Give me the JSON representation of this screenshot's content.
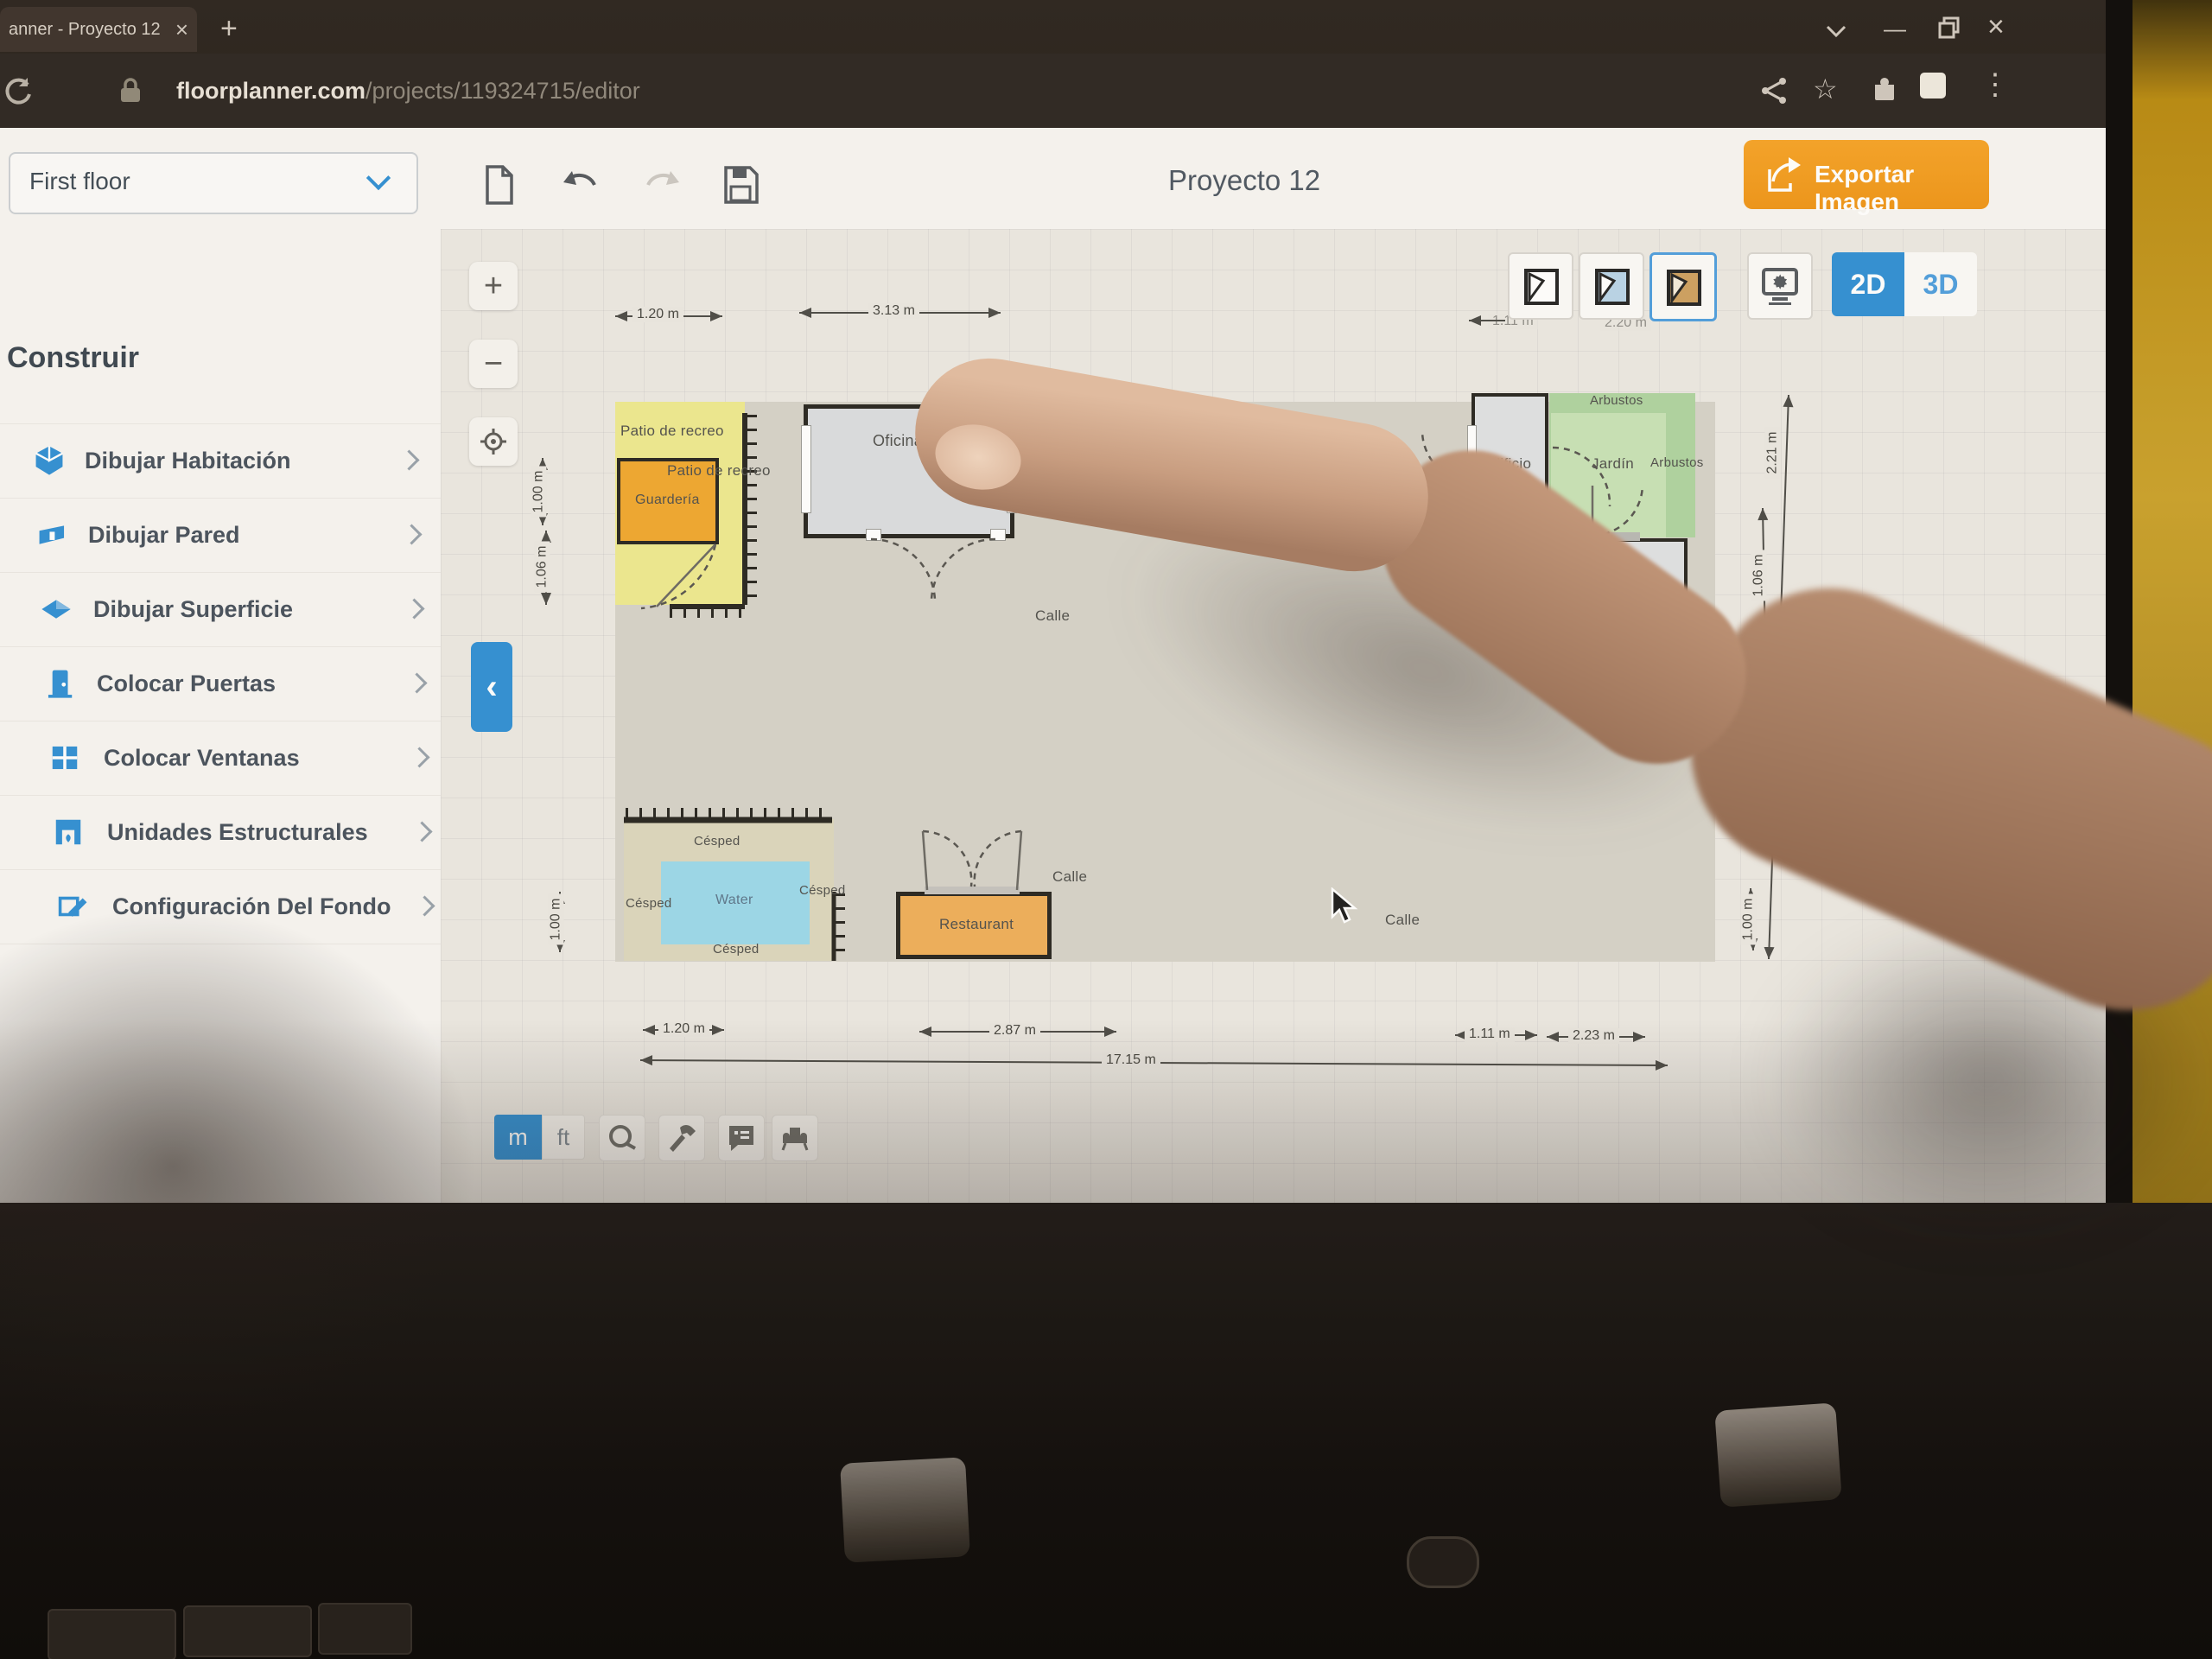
{
  "browser": {
    "tab_title": "anner - Proyecto 12",
    "tab_close": "×",
    "new_tab": "+",
    "url_domain": "floorplanner.com",
    "url_path": "/projects/119324715/editor",
    "minimize": "—",
    "close": "×",
    "menu_dots": "⋮"
  },
  "topbar": {
    "floor_selector": "First floor",
    "title": "Proyecto 12",
    "export_label": "Exportar Imagen"
  },
  "sidebar": {
    "heading": "Construir",
    "items": [
      {
        "label": "Dibujar Habitación"
      },
      {
        "label": "Dibujar Pared"
      },
      {
        "label": "Dibujar Superficie"
      },
      {
        "label": "Colocar Puertas"
      },
      {
        "label": "Colocar Ventanas"
      },
      {
        "label": "Unidades Estructurales"
      },
      {
        "label": "Configuración Del Fondo"
      }
    ],
    "help": "?"
  },
  "view": {
    "mode_2d": "2D",
    "mode_3d": "3D"
  },
  "units": {
    "m": "m",
    "ft": "ft"
  },
  "zoom": {
    "in": "+",
    "out": "−",
    "collapse": "‹"
  },
  "plan": {
    "patio": "Patio de recreo",
    "patio2": "Patio de recreo",
    "guarderia": "Guardería",
    "oficina": "Oficina",
    "arbustos_top": "Arbustos",
    "edificio1": "Edificio",
    "jardin": "Jardín",
    "arbustos_right": "Arbustos",
    "garaje": "Garaje",
    "edificio2": "Edificio",
    "calle_center": "Calle",
    "calle_restaurant": "Calle",
    "calle_right": "Calle",
    "cesped_top": "Césped",
    "cesped_left": "Césped",
    "cesped_right": "Césped",
    "cesped_bottom": "Césped",
    "water": "Water",
    "restaurant": "Restaurant"
  },
  "dims": {
    "top_small": "1.20 m",
    "top_office": "3.13 m",
    "left_upper": "1.00 m",
    "left_lower": "1.06 m",
    "left_bottom": "1.00 m",
    "right_tall": "2.21 m",
    "right_mid": "1.06 m",
    "right_bottom": "1.00 m",
    "bottom_1": "1.20 m",
    "bottom_2": "2.87 m",
    "bottom_3": "1.11 m",
    "bottom_4": "2.23 m",
    "bottom_total": "17.15 m",
    "behind_1": "1.11 m",
    "behind_2": "2.20 m"
  },
  "colors": {
    "accent_blue": "#2f8fd4",
    "export_orange": "#f29d1e",
    "patio_yellow": "#eee98f",
    "guarderia_orange": "#f0a72e",
    "water_blue": "#9ad8ea",
    "restaurant_orange": "#efae59",
    "garden_green": "#c8e2b6",
    "shrub_green": "#aed3a0"
  }
}
